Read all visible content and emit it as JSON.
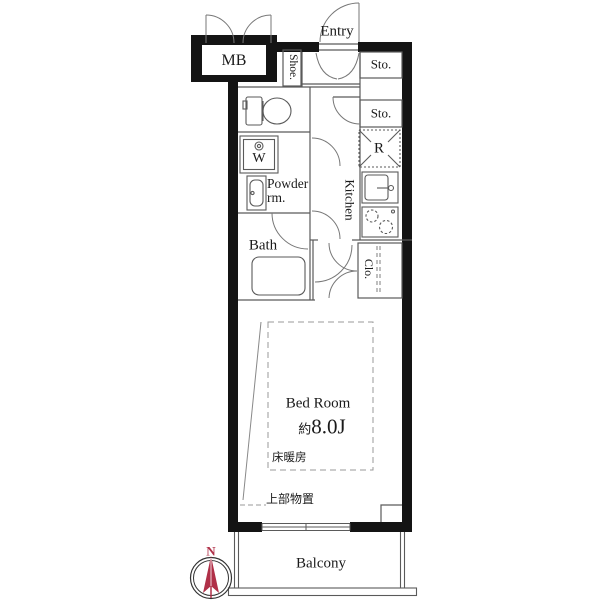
{
  "plan": {
    "title": "apartment-floor-plan",
    "colors": {
      "wall": "#141414",
      "line": "#5a5a5a",
      "dash": "#999999",
      "compass_red": "#b03048"
    },
    "rooms": {
      "mb_label": "MB",
      "entry_label": "Entry",
      "shoe_label": "Shoe.",
      "storage_top_label": "Sto.",
      "storage_mid_label": "Sto.",
      "refrigerator_label": "R",
      "kitchen_label": "Kitchen",
      "washer_label": "W",
      "powder_label_line1": "Powder",
      "powder_label_line2": "rm.",
      "bath_label": "Bath",
      "closet_label": "Clo.",
      "bedroom_label": "Bed Room",
      "bedroom_size_prefix": "約",
      "bedroom_size_value": "8.0J",
      "floor_heating_label": "床暖房",
      "upper_storage_label": "上部物置",
      "balcony_label": "Balcony"
    },
    "compass": {
      "north_label": "N"
    }
  }
}
